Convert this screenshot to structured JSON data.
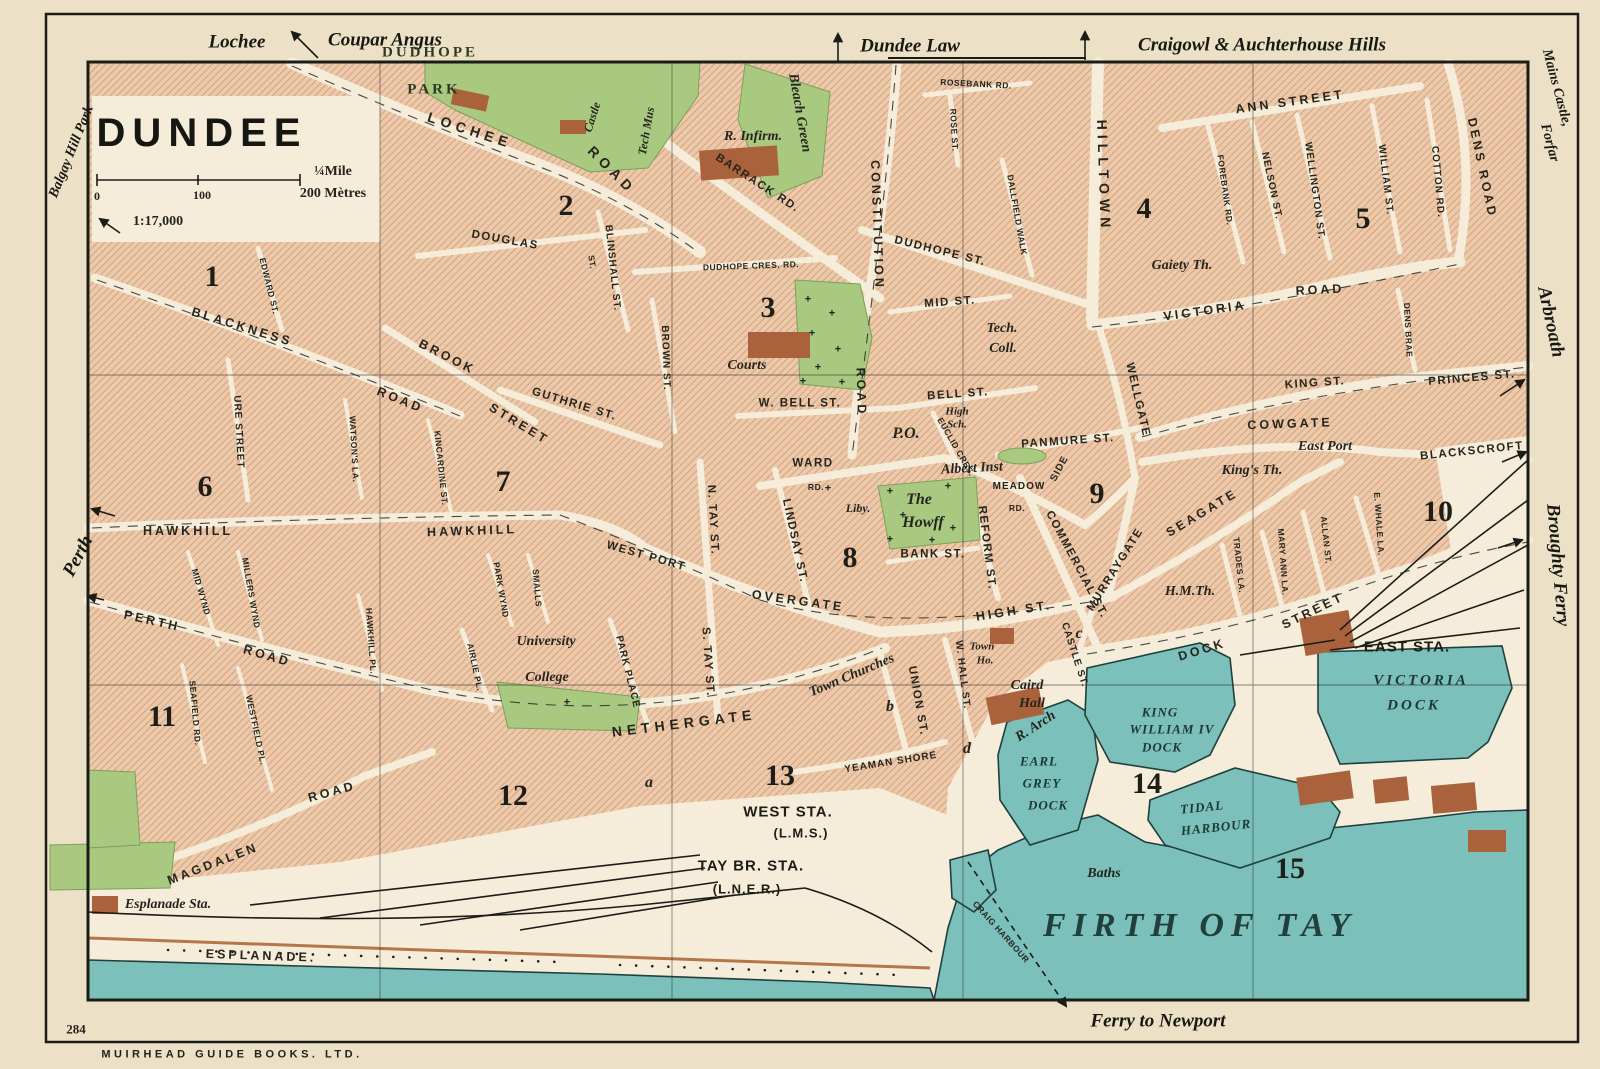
{
  "meta": {
    "title": "DUNDEE",
    "scale_ratio": "1:17,000",
    "scale_half_mile": "¼Mile",
    "scale_metres": "200 Mètres",
    "scale_zero": "0",
    "scale_hundred": "100",
    "plate_number": "284",
    "publisher": "MUIRHEAD GUIDE BOOKS. LTD."
  },
  "map_labels": [
    {
      "t": "Lochee",
      "x": 237,
      "y": 42,
      "r": 0,
      "c": "edge"
    },
    {
      "t": "Coupar Angus",
      "x": 385,
      "y": 40,
      "r": 0,
      "c": "edge"
    },
    {
      "t": "Dundee Law",
      "x": 910,
      "y": 46,
      "r": 0,
      "c": "edge"
    },
    {
      "t": "Craigowl & Auchterhouse Hills",
      "x": 1262,
      "y": 45,
      "r": 0,
      "c": "edge"
    },
    {
      "t": "Mains Castle,",
      "x": 1556,
      "y": 88,
      "r": 75,
      "c": "edge-s"
    },
    {
      "t": "Forfar",
      "x": 1549,
      "y": 143,
      "r": 75,
      "c": "edge-s"
    },
    {
      "t": "Arbroath",
      "x": 1551,
      "y": 322,
      "r": 78,
      "c": "edge"
    },
    {
      "t": "Broughty Ferry",
      "x": 1558,
      "y": 565,
      "r": 85,
      "c": "edge"
    },
    {
      "t": "Balgay Hill Park",
      "x": 72,
      "y": 152,
      "r": -68,
      "c": "edge-s"
    },
    {
      "t": "Perth",
      "x": 78,
      "y": 556,
      "r": -62,
      "c": "edge"
    },
    {
      "t": "Ferry to Newport",
      "x": 1158,
      "y": 1021,
      "r": 0,
      "c": "edge"
    },
    {
      "t": "DUDHOPE",
      "x": 430,
      "y": 53,
      "r": 0,
      "c": "park"
    },
    {
      "t": "PARK",
      "x": 434,
      "y": 90,
      "r": 0,
      "c": "park"
    },
    {
      "t": "LOCHEE",
      "x": 470,
      "y": 130,
      "r": 18,
      "c": "rdl"
    },
    {
      "t": "ROAD",
      "x": 612,
      "y": 170,
      "r": 45,
      "c": "rdl"
    },
    {
      "t": "Castle",
      "x": 592,
      "y": 117,
      "r": -72,
      "c": "pois"
    },
    {
      "t": "Tech Mus",
      "x": 646,
      "y": 131,
      "r": -80,
      "c": "pois"
    },
    {
      "t": "R. Infirm.",
      "x": 753,
      "y": 137,
      "r": 0,
      "c": "poi"
    },
    {
      "t": "Bleach Green",
      "x": 799,
      "y": 113,
      "r": 80,
      "c": "poi"
    },
    {
      "t": "BARRACK RD.",
      "x": 757,
      "y": 184,
      "r": 33,
      "c": "rd"
    },
    {
      "t": "ROSEBANK RD.",
      "x": 976,
      "y": 84,
      "r": 3,
      "c": "rdx"
    },
    {
      "t": "ROSE ST.",
      "x": 954,
      "y": 130,
      "r": 87,
      "c": "rdx"
    },
    {
      "t": "DALLFIELD WALK",
      "x": 1017,
      "y": 215,
      "r": 80,
      "c": "rdx"
    },
    {
      "t": "HILLTOWN",
      "x": 1104,
      "y": 176,
      "r": 88,
      "c": "rdl"
    },
    {
      "t": "ANN STREET",
      "x": 1290,
      "y": 102,
      "r": -8,
      "c": "rdm"
    },
    {
      "t": "FOREBANK RD.",
      "x": 1225,
      "y": 190,
      "r": 82,
      "c": "rdx"
    },
    {
      "t": "NELSON ST.",
      "x": 1271,
      "y": 186,
      "r": 78,
      "c": "rds"
    },
    {
      "t": "WELLINGTON ST.",
      "x": 1314,
      "y": 191,
      "r": 82,
      "c": "rds"
    },
    {
      "t": "WILLIAM ST.",
      "x": 1385,
      "y": 180,
      "r": 83,
      "c": "rds"
    },
    {
      "t": "COTTON RD.",
      "x": 1437,
      "y": 182,
      "r": 85,
      "c": "rds"
    },
    {
      "t": "DENS ROAD",
      "x": 1482,
      "y": 168,
      "r": 78,
      "c": "rdm"
    },
    {
      "t": "CONSTITUTION",
      "x": 877,
      "y": 225,
      "r": 88,
      "c": "rdm"
    },
    {
      "t": "ROAD",
      "x": 861,
      "y": 392,
      "r": 88,
      "c": "rdm"
    },
    {
      "t": "DUDHOPE ST.",
      "x": 940,
      "y": 252,
      "r": 14,
      "c": "rd"
    },
    {
      "t": "DUDHOPE CRES. RD.",
      "x": 751,
      "y": 266,
      "r": -2,
      "c": "rdx"
    },
    {
      "t": "MID ST.",
      "x": 950,
      "y": 303,
      "r": -4,
      "c": "rd"
    },
    {
      "t": "DOUGLAS",
      "x": 505,
      "y": 241,
      "r": 10,
      "c": "rd"
    },
    {
      "t": "ST.",
      "x": 592,
      "y": 262,
      "r": 80,
      "c": "rdx"
    },
    {
      "t": "BLINSHALL ST.",
      "x": 612,
      "y": 268,
      "r": 84,
      "c": "rds"
    },
    {
      "t": "BROWN ST.",
      "x": 665,
      "y": 358,
      "r": 88,
      "c": "rds"
    },
    {
      "t": "Gaiety Th.",
      "x": 1182,
      "y": 266,
      "r": 0,
      "c": "poi"
    },
    {
      "t": "VICTORIA",
      "x": 1205,
      "y": 311,
      "r": -8,
      "c": "rdm"
    },
    {
      "t": "ROAD",
      "x": 1320,
      "y": 290,
      "r": -3,
      "c": "rdm"
    },
    {
      "t": "Tech.",
      "x": 1002,
      "y": 329,
      "r": 0,
      "c": "poi"
    },
    {
      "t": "Coll.",
      "x": 1003,
      "y": 349,
      "r": 0,
      "c": "poi"
    },
    {
      "t": "Courts",
      "x": 747,
      "y": 366,
      "r": 0,
      "c": "poi"
    },
    {
      "t": "W. BELL ST.",
      "x": 800,
      "y": 404,
      "r": 0,
      "c": "rd"
    },
    {
      "t": "BELL ST.",
      "x": 958,
      "y": 395,
      "r": -4,
      "c": "rd"
    },
    {
      "t": "KING ST.",
      "x": 1315,
      "y": 384,
      "r": -4,
      "c": "rd"
    },
    {
      "t": "PRINCES ST.",
      "x": 1472,
      "y": 379,
      "r": -5,
      "c": "rd"
    },
    {
      "t": "P.O.",
      "x": 906,
      "y": 434,
      "r": 0,
      "c": "poib"
    },
    {
      "t": "High",
      "x": 957,
      "y": 412,
      "r": 0,
      "c": "poix"
    },
    {
      "t": "Sch.",
      "x": 957,
      "y": 425,
      "r": 0,
      "c": "poix"
    },
    {
      "t": "EUCLID CRES.",
      "x": 956,
      "y": 447,
      "r": 60,
      "c": "rdx"
    },
    {
      "t": "PANMURE ST.",
      "x": 1068,
      "y": 442,
      "r": -4,
      "c": "rd"
    },
    {
      "t": "Albert Inst",
      "x": 972,
      "y": 469,
      "r": -3,
      "c": "poi"
    },
    {
      "t": "MEADOW",
      "x": 1019,
      "y": 487,
      "r": 0,
      "c": "rds"
    },
    {
      "t": "SIDE",
      "x": 1060,
      "y": 469,
      "r": -62,
      "c": "rds"
    },
    {
      "t": "RD.",
      "x": 1017,
      "y": 508,
      "r": 0,
      "c": "rdx"
    },
    {
      "t": "WELLGATE",
      "x": 1137,
      "y": 400,
      "r": 77,
      "c": "rd"
    },
    {
      "t": "COWGATE",
      "x": 1290,
      "y": 424,
      "r": -2,
      "c": "rdm"
    },
    {
      "t": "East Port",
      "x": 1325,
      "y": 447,
      "r": 0,
      "c": "poi"
    },
    {
      "t": "BLACKSCROFT",
      "x": 1472,
      "y": 452,
      "r": -6,
      "c": "rd"
    },
    {
      "t": "King's Th.",
      "x": 1252,
      "y": 471,
      "r": 0,
      "c": "poi"
    },
    {
      "t": "DENS BRAE",
      "x": 1408,
      "y": 330,
      "r": 87,
      "c": "rdx"
    },
    {
      "t": "BLACKNESS",
      "x": 242,
      "y": 327,
      "r": 17,
      "c": "rdm"
    },
    {
      "t": "ROAD",
      "x": 400,
      "y": 400,
      "r": 22,
      "c": "rdm"
    },
    {
      "t": "EDWARD ST.",
      "x": 269,
      "y": 286,
      "r": 76,
      "c": "rdx"
    },
    {
      "t": "URE STREET",
      "x": 238,
      "y": 432,
      "r": 87,
      "c": "rds"
    },
    {
      "t": "WATSON'S LA.",
      "x": 354,
      "y": 449,
      "r": 87,
      "c": "rdx"
    },
    {
      "t": "KINCARDINE ST.",
      "x": 441,
      "y": 468,
      "r": 84,
      "c": "rdx"
    },
    {
      "t": "BROOK",
      "x": 447,
      "y": 357,
      "r": 27,
      "c": "rdm"
    },
    {
      "t": "STREET",
      "x": 519,
      "y": 424,
      "r": 31,
      "c": "rdm"
    },
    {
      "t": "GUTHRIE ST.",
      "x": 574,
      "y": 405,
      "r": 17,
      "c": "rd"
    },
    {
      "t": "HAWKHILL",
      "x": 188,
      "y": 531,
      "r": 0,
      "c": "rdm"
    },
    {
      "t": "HAWKHILL",
      "x": 472,
      "y": 531,
      "r": -2,
      "c": "rdm"
    },
    {
      "t": "WEST PORT",
      "x": 646,
      "y": 557,
      "r": 16,
      "c": "rd"
    },
    {
      "t": "N. TAY ST.",
      "x": 712,
      "y": 520,
      "r": 87,
      "c": "rd"
    },
    {
      "t": "S. TAY ST.",
      "x": 707,
      "y": 662,
      "r": 86,
      "c": "rd"
    },
    {
      "t": "LINDSAY ST.",
      "x": 794,
      "y": 541,
      "r": 78,
      "c": "rd"
    },
    {
      "t": "OVERGATE",
      "x": 798,
      "y": 601,
      "r": 8,
      "c": "rdm"
    },
    {
      "t": "WARD",
      "x": 813,
      "y": 464,
      "r": 0,
      "c": "rd"
    },
    {
      "t": "RD.",
      "x": 816,
      "y": 487,
      "r": 0,
      "c": "rdx"
    },
    {
      "t": "Liby.",
      "x": 858,
      "y": 508,
      "r": 0,
      "c": "pois"
    },
    {
      "t": "The",
      "x": 919,
      "y": 500,
      "r": 0,
      "c": "poib"
    },
    {
      "t": "Howff",
      "x": 923,
      "y": 523,
      "r": 0,
      "c": "poib"
    },
    {
      "t": "BANK ST.",
      "x": 933,
      "y": 555,
      "r": 0,
      "c": "rd"
    },
    {
      "t": "REFORM ST.",
      "x": 986,
      "y": 548,
      "r": 83,
      "c": "rd"
    },
    {
      "t": "COMMERCIAL ST.",
      "x": 1076,
      "y": 565,
      "r": 62,
      "c": "rd"
    },
    {
      "t": "MURRAYGATE",
      "x": 1116,
      "y": 570,
      "r": -58,
      "c": "rd"
    },
    {
      "t": "SEAGATE",
      "x": 1202,
      "y": 513,
      "r": -31,
      "c": "rdm"
    },
    {
      "t": "TRADES LA.",
      "x": 1239,
      "y": 565,
      "r": 84,
      "c": "rdx"
    },
    {
      "t": "MARY ANN LA.",
      "x": 1283,
      "y": 562,
      "r": 86,
      "c": "rdx"
    },
    {
      "t": "ALLAN ST.",
      "x": 1326,
      "y": 540,
      "r": 84,
      "c": "rdx"
    },
    {
      "t": "E. WHALE LA.",
      "x": 1379,
      "y": 524,
      "r": 86,
      "c": "rdx"
    },
    {
      "t": "H.M.Th.",
      "x": 1190,
      "y": 592,
      "r": 0,
      "c": "poi"
    },
    {
      "t": "HIGH ST.",
      "x": 1014,
      "y": 611,
      "r": -9,
      "c": "rdm"
    },
    {
      "t": "DOCK",
      "x": 1202,
      "y": 650,
      "r": -17,
      "c": "rdm"
    },
    {
      "t": "STREET",
      "x": 1313,
      "y": 611,
      "r": -26,
      "c": "rdm"
    },
    {
      "t": "CASTLE ST.",
      "x": 1074,
      "y": 655,
      "r": 72,
      "c": "rds"
    },
    {
      "t": "UNION ST.",
      "x": 917,
      "y": 701,
      "r": 80,
      "c": "rd"
    },
    {
      "t": "W. HALL ST.",
      "x": 962,
      "y": 675,
      "r": 83,
      "c": "rds"
    },
    {
      "t": "Town",
      "x": 982,
      "y": 647,
      "r": 0,
      "c": "poix"
    },
    {
      "t": "Ho.",
      "x": 985,
      "y": 661,
      "r": 0,
      "c": "poix"
    },
    {
      "t": "Caird",
      "x": 1027,
      "y": 686,
      "r": 0,
      "c": "poi"
    },
    {
      "t": "Hall",
      "x": 1032,
      "y": 704,
      "r": 0,
      "c": "poi"
    },
    {
      "t": "Town Churches",
      "x": 852,
      "y": 676,
      "r": -23,
      "c": "poi"
    },
    {
      "t": "NETHERGATE",
      "x": 684,
      "y": 723,
      "r": -7,
      "c": "rdl"
    },
    {
      "t": "YEAMAN SHORE",
      "x": 891,
      "y": 763,
      "r": -9,
      "c": "rds"
    },
    {
      "t": "R. Arch",
      "x": 1036,
      "y": 727,
      "r": -33,
      "c": "poi"
    },
    {
      "t": "PERTH",
      "x": 152,
      "y": 621,
      "r": 13,
      "c": "rdm"
    },
    {
      "t": "ROAD",
      "x": 267,
      "y": 656,
      "r": 16,
      "c": "rdm"
    },
    {
      "t": "MID WYND",
      "x": 201,
      "y": 592,
      "r": 74,
      "c": "rdx"
    },
    {
      "t": "MILLERS WYND",
      "x": 251,
      "y": 593,
      "r": 80,
      "c": "rdx"
    },
    {
      "t": "SEAFIELD RD.",
      "x": 195,
      "y": 713,
      "r": 85,
      "c": "rdx"
    },
    {
      "t": "WESTFIELD PL.",
      "x": 256,
      "y": 730,
      "r": 78,
      "c": "rdx"
    },
    {
      "t": "HAWKHILL PL.",
      "x": 371,
      "y": 641,
      "r": 86,
      "c": "rdx"
    },
    {
      "t": "AIRLIE PL.",
      "x": 475,
      "y": 667,
      "r": 78,
      "c": "rdx"
    },
    {
      "t": "PARK WYND",
      "x": 501,
      "y": 590,
      "r": 80,
      "c": "rdx"
    },
    {
      "t": "SMALLS",
      "x": 537,
      "y": 588,
      "r": 85,
      "c": "rdx"
    },
    {
      "t": "PARK PLACE",
      "x": 627,
      "y": 672,
      "r": 76,
      "c": "rds"
    },
    {
      "t": "University",
      "x": 546,
      "y": 642,
      "r": 0,
      "c": "poi"
    },
    {
      "t": "College",
      "x": 547,
      "y": 678,
      "r": 0,
      "c": "poi"
    },
    {
      "t": "MAGDALEN",
      "x": 213,
      "y": 864,
      "r": -21,
      "c": "rdm"
    },
    {
      "t": "ROAD",
      "x": 332,
      "y": 792,
      "r": -15,
      "c": "rdm"
    },
    {
      "t": "Esplanade Sta.",
      "x": 168,
      "y": 905,
      "r": 0,
      "c": "poi"
    },
    {
      "t": "ESPLANADE.",
      "x": 261,
      "y": 956,
      "r": 2,
      "c": "rdm"
    },
    {
      "t": "WEST STA.",
      "x": 788,
      "y": 812,
      "r": 0,
      "c": "sta"
    },
    {
      "t": "(L.M.S.)",
      "x": 801,
      "y": 833,
      "r": 0,
      "c": "stas"
    },
    {
      "t": "TAY BR. STA.",
      "x": 751,
      "y": 866,
      "r": 0,
      "c": "sta"
    },
    {
      "t": "(L.N.E.R.)",
      "x": 747,
      "y": 889,
      "r": 0,
      "c": "stas"
    },
    {
      "t": "EAST STA.",
      "x": 1407,
      "y": 647,
      "r": 0,
      "c": "sta"
    },
    {
      "t": "KING",
      "x": 1160,
      "y": 712,
      "r": 0,
      "c": "dock"
    },
    {
      "t": "WILLIAM IV",
      "x": 1172,
      "y": 729,
      "r": 0,
      "c": "dock"
    },
    {
      "t": "DOCK",
      "x": 1162,
      "y": 747,
      "r": 0,
      "c": "dock"
    },
    {
      "t": "EARL",
      "x": 1039,
      "y": 761,
      "r": 0,
      "c": "dock"
    },
    {
      "t": "GREY",
      "x": 1042,
      "y": 783,
      "r": 0,
      "c": "dock"
    },
    {
      "t": "DOCK",
      "x": 1048,
      "y": 805,
      "r": 0,
      "c": "dock"
    },
    {
      "t": "TIDAL",
      "x": 1202,
      "y": 807,
      "r": -6,
      "c": "dock"
    },
    {
      "t": "HARBOUR",
      "x": 1216,
      "y": 827,
      "r": -6,
      "c": "dock"
    },
    {
      "t": "VICTORIA",
      "x": 1421,
      "y": 681,
      "r": 0,
      "c": "docki"
    },
    {
      "t": "DOCK",
      "x": 1414,
      "y": 706,
      "r": 0,
      "c": "docki"
    },
    {
      "t": "Baths",
      "x": 1104,
      "y": 874,
      "r": 0,
      "c": "poi"
    },
    {
      "t": "CRAIG HARBOUR",
      "x": 1001,
      "y": 932,
      "r": 48,
      "c": "rdx"
    },
    {
      "t": "FIRTH OF TAY",
      "x": 1200,
      "y": 926,
      "r": 0,
      "c": "sea"
    },
    {
      "t": "1",
      "x": 212,
      "y": 277,
      "r": 0,
      "c": "num"
    },
    {
      "t": "2",
      "x": 566,
      "y": 206,
      "r": 0,
      "c": "num"
    },
    {
      "t": "3",
      "x": 768,
      "y": 308,
      "r": 0,
      "c": "num"
    },
    {
      "t": "4",
      "x": 1144,
      "y": 209,
      "r": 0,
      "c": "num"
    },
    {
      "t": "5",
      "x": 1363,
      "y": 219,
      "r": 0,
      "c": "num"
    },
    {
      "t": "6",
      "x": 205,
      "y": 487,
      "r": 0,
      "c": "num"
    },
    {
      "t": "7",
      "x": 503,
      "y": 482,
      "r": 0,
      "c": "num"
    },
    {
      "t": "8",
      "x": 850,
      "y": 558,
      "r": 0,
      "c": "num"
    },
    {
      "t": "9",
      "x": 1097,
      "y": 494,
      "r": 0,
      "c": "num"
    },
    {
      "t": "10",
      "x": 1438,
      "y": 512,
      "r": 0,
      "c": "num"
    },
    {
      "t": "11",
      "x": 162,
      "y": 717,
      "r": 0,
      "c": "num"
    },
    {
      "t": "12",
      "x": 513,
      "y": 796,
      "r": 0,
      "c": "num"
    },
    {
      "t": "13",
      "x": 780,
      "y": 776,
      "r": 0,
      "c": "num"
    },
    {
      "t": "14",
      "x": 1147,
      "y": 784,
      "r": 0,
      "c": "num"
    },
    {
      "t": "15",
      "x": 1290,
      "y": 869,
      "r": 0,
      "c": "num"
    },
    {
      "t": "a",
      "x": 649,
      "y": 783,
      "r": 0,
      "c": "ltr"
    },
    {
      "t": "b",
      "x": 890,
      "y": 707,
      "r": 0,
      "c": "ltr"
    },
    {
      "t": "c",
      "x": 1079,
      "y": 634,
      "r": 0,
      "c": "ltr"
    },
    {
      "t": "d",
      "x": 967,
      "y": 749,
      "r": 0,
      "c": "ltr"
    },
    {
      "t": "+",
      "x": 808,
      "y": 300,
      "r": 0,
      "c": "cross"
    },
    {
      "t": "+",
      "x": 832,
      "y": 314,
      "r": 0,
      "c": "cross"
    },
    {
      "t": "+",
      "x": 812,
      "y": 334,
      "r": 0,
      "c": "cross"
    },
    {
      "t": "+",
      "x": 838,
      "y": 350,
      "r": 0,
      "c": "cross"
    },
    {
      "t": "+",
      "x": 818,
      "y": 368,
      "r": 0,
      "c": "cross"
    },
    {
      "t": "+",
      "x": 842,
      "y": 383,
      "r": 0,
      "c": "cross"
    },
    {
      "t": "+",
      "x": 803,
      "y": 382,
      "r": 0,
      "c": "cross"
    },
    {
      "t": "+",
      "x": 890,
      "y": 492,
      "r": 0,
      "c": "cross"
    },
    {
      "t": "+",
      "x": 948,
      "y": 487,
      "r": 0,
      "c": "cross"
    },
    {
      "t": "+",
      "x": 903,
      "y": 516,
      "r": 0,
      "c": "cross"
    },
    {
      "t": "+",
      "x": 953,
      "y": 529,
      "r": 0,
      "c": "cross"
    },
    {
      "t": "+",
      "x": 890,
      "y": 540,
      "r": 0,
      "c": "cross"
    },
    {
      "t": "+",
      "x": 932,
      "y": 541,
      "r": 0,
      "c": "cross"
    },
    {
      "t": "+",
      "x": 828,
      "y": 489,
      "r": 0,
      "c": "cross"
    },
    {
      "t": "+",
      "x": 567,
      "y": 703,
      "r": 0,
      "c": "cross"
    }
  ]
}
